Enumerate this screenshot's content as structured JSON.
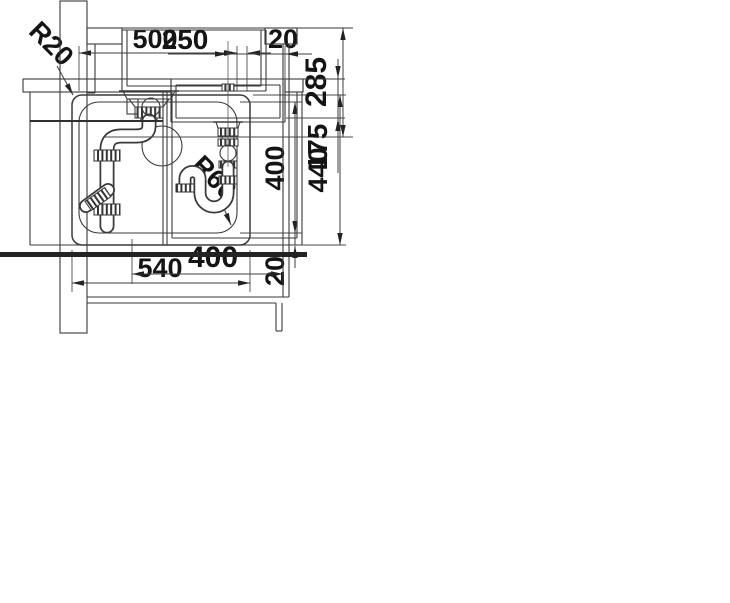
{
  "plan": {
    "inner_width_mm": "500",
    "rim_offset_top_right_mm": "20",
    "inner_depth_mm": "400",
    "outer_depth_mm": "440",
    "rim_offset_bottom_mm": "20",
    "outer_width_mm": "540",
    "outer_corner_radius": "R20",
    "inner_corner_radius": "R60"
  },
  "side": {
    "drain_outlet_height_mm": "285",
    "cabinet_clearance_mm": "400"
  },
  "front": {
    "drain_center_offset_mm": "250",
    "bowl_depth_mm": "175"
  }
}
